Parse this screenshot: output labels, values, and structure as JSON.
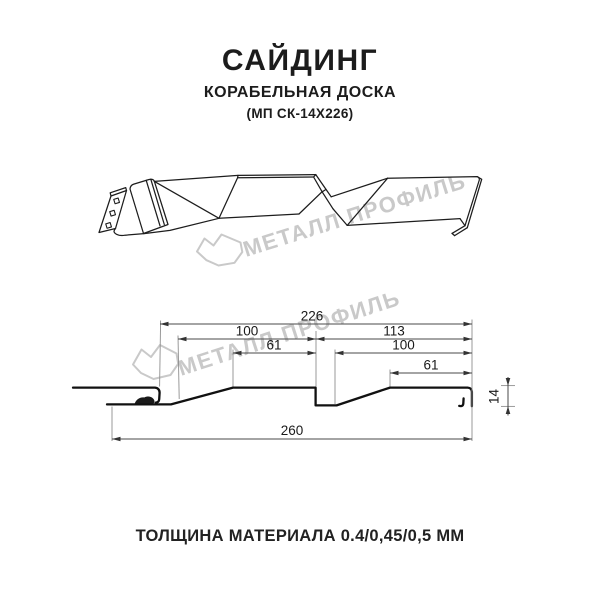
{
  "header": {
    "title": "САЙДИНГ",
    "subtitle": "КОРАБЕЛЬНАЯ ДОСКА",
    "model": "(МП СК-14Х226)"
  },
  "watermark": {
    "text": "МЕТАЛЛ ПРОФИЛЬ",
    "color": "#c9c9c9"
  },
  "drawing": {
    "dimensions_mm": {
      "overall_top": "226",
      "left_pitch": "100",
      "left_flat": "61",
      "right_pitch": "113",
      "right_inner": "100",
      "right_flat": "61",
      "overall_bottom": "260",
      "profile_height": "14"
    }
  },
  "footer": {
    "thickness": "ТОЛЩИНА МАТЕРИАЛА 0.4/0,45/0,5 ММ"
  },
  "colors": {
    "line": "#1d1d1d",
    "dimension": "#4a4a4a",
    "watermark": "#c9c9c9"
  }
}
